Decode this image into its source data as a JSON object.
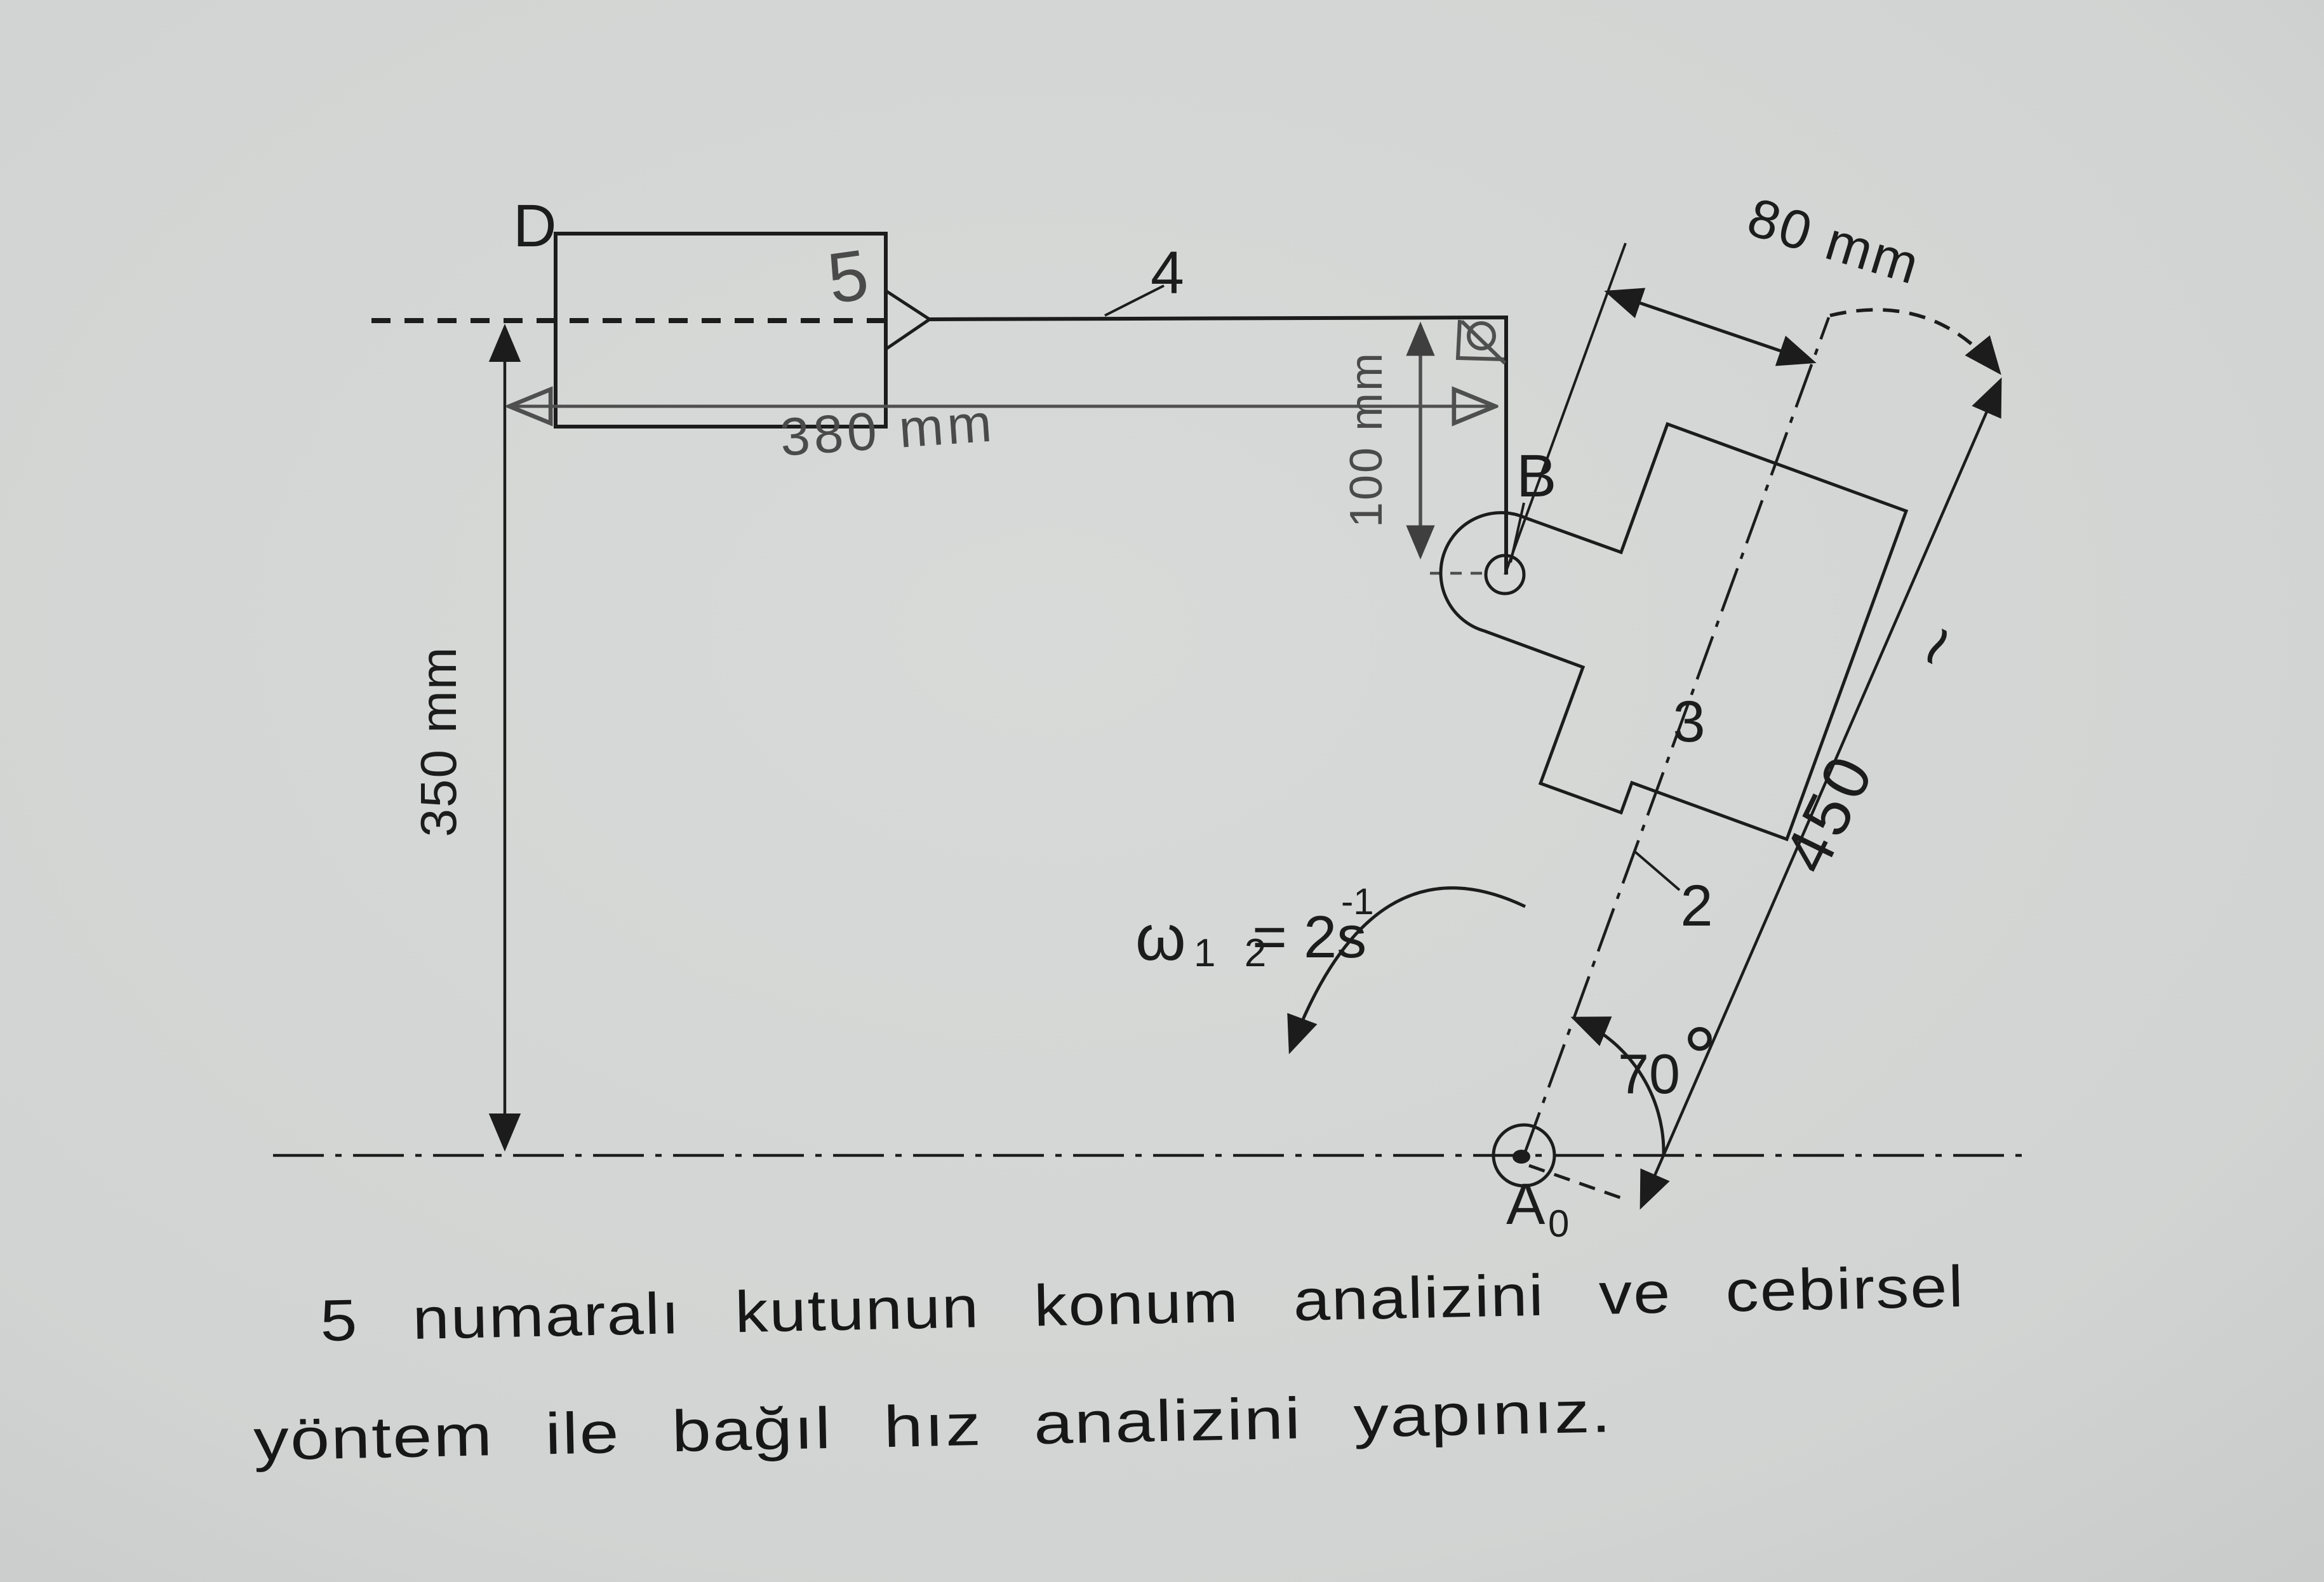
{
  "figure": {
    "labels": {
      "D": "D",
      "B": "B",
      "A": "A",
      "A_sub": "0",
      "link2": "2",
      "block3": "3",
      "link4": "4",
      "box5": "5"
    },
    "dimensions": {
      "height_350": "350 mm",
      "length_380": "380 mm",
      "offset_100": "100 mm",
      "offset_80": "80 mm",
      "length_450": "450",
      "squiggle": "~",
      "angle_value": "70",
      "angle_degree": "°"
    },
    "angular_velocity": {
      "symbol": "ω",
      "subscript": "1 2",
      "equals": "= 2s",
      "exponent": "-1"
    }
  },
  "problem_statement": {
    "line1": "5 numaralı kutunun konum analizini ve cebirsel",
    "line2": "yöntem ile bağıl hız analizini yapınız."
  },
  "colors": {
    "paper": "#d3d5d4",
    "ink": "#1c1c1c",
    "pencil": "#4f4f4f"
  }
}
